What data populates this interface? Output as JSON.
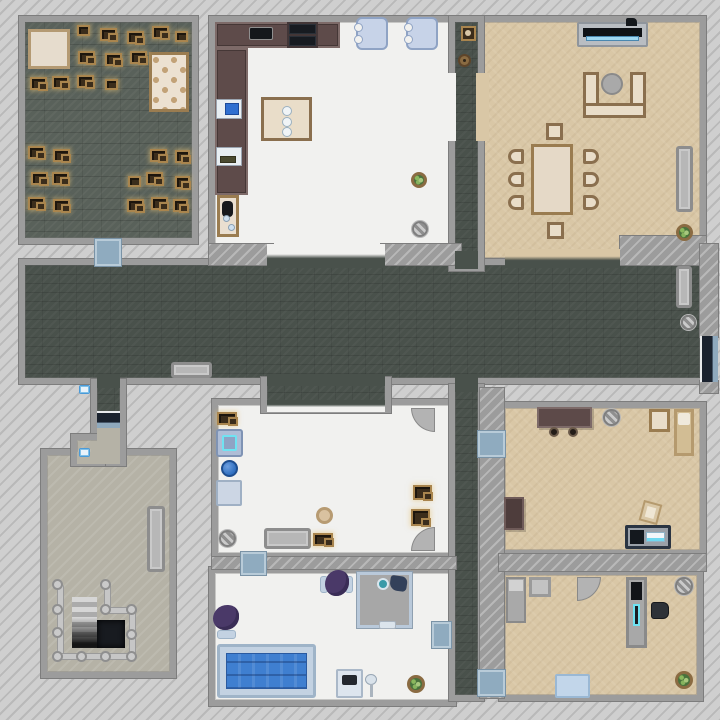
{
  "scene": {
    "title": "top-down house map",
    "canvas": {
      "w": 720,
      "h": 720
    }
  },
  "palette": {
    "exterior": "#cfcfcf",
    "wall": "#9c9c9c",
    "hallway_floor": "#49514b",
    "storage_floor": "#59615a",
    "white_floor": "#f1f1ef",
    "tan_floor": "#d9c7a6",
    "basement_floor": "#b5b2a6",
    "door_mat": "#8fabbf",
    "entry_door": "#1a222e",
    "water": "#3f7fd0",
    "highlight": "#6fe3f2",
    "crate": "#3b2d1b",
    "crate_trim": "#a9854e",
    "plant": "#49723c",
    "sofa_trim": "#8a6f4e",
    "counter": "#5e4b4a",
    "purple_chair": "#4a3968"
  },
  "rooms": [
    {
      "n": "storage-room",
      "f": "f-brickdark",
      "x": 25,
      "y": 22,
      "w": 167,
      "h": 216
    },
    {
      "n": "kitchen",
      "f": "f-white",
      "x": 215,
      "y": 22,
      "w": 235,
      "h": 226
    },
    {
      "n": "living-room",
      "f": "f-tan",
      "x": 482,
      "y": 22,
      "w": 218,
      "h": 236
    },
    {
      "n": "hallway",
      "f": "f-dark",
      "x": 25,
      "y": 265,
      "w": 675,
      "h": 113
    },
    {
      "n": "top-corridor",
      "f": "f-dark",
      "x": 455,
      "y": 22,
      "w": 23,
      "h": 243
    },
    {
      "n": "middle-room",
      "f": "f-white",
      "x": 218,
      "y": 405,
      "w": 237,
      "h": 148
    },
    {
      "n": "hall-alcove",
      "f": "f-dark",
      "x": 267,
      "y": 383,
      "w": 118,
      "h": 24
    },
    {
      "n": "bathroom",
      "f": "f-white",
      "x": 215,
      "y": 573,
      "w": 235,
      "h": 127
    },
    {
      "n": "vertical-corridor",
      "f": "f-dark",
      "x": 455,
      "y": 390,
      "w": 23,
      "h": 305
    },
    {
      "n": "bedroom-right",
      "f": "f-tan",
      "x": 505,
      "y": 408,
      "w": 195,
      "h": 142
    },
    {
      "n": "bedroom-bottom",
      "f": "f-tan",
      "x": 505,
      "y": 575,
      "w": 192,
      "h": 120
    },
    {
      "n": "basement-room",
      "f": "f-beige",
      "x": 47,
      "y": 455,
      "w": 123,
      "h": 217
    },
    {
      "n": "entry-corridor",
      "f": "f-dark",
      "x": 97,
      "y": 385,
      "w": 23,
      "h": 75
    },
    {
      "n": "entry-notch",
      "f": "f-beige",
      "x": 77,
      "y": 440,
      "w": 22,
      "h": 20
    }
  ],
  "walls": [
    {
      "n": "wall-living-nook",
      "x": 620,
      "y": 236,
      "w": 86,
      "h": 29
    },
    {
      "n": "wall-right-top",
      "x": 700,
      "y": 244,
      "w": 18,
      "h": 93
    },
    {
      "n": "wall-right-bottom",
      "x": 700,
      "y": 381,
      "w": 18,
      "h": 12
    },
    {
      "n": "wall-kitchen-hall-left",
      "x": 209,
      "y": 244,
      "w": 64,
      "h": 21
    },
    {
      "n": "wall-kitchen-hall-right",
      "x": 381,
      "y": 244,
      "w": 80,
      "h": 21
    },
    {
      "n": "wall-corridor-right",
      "x": 480,
      "y": 388,
      "w": 24,
      "h": 310
    },
    {
      "n": "wall-mid-bath",
      "x": 212,
      "y": 557,
      "w": 244,
      "h": 12
    },
    {
      "n": "wall-bedrooms",
      "x": 499,
      "y": 554,
      "w": 207,
      "h": 17
    }
  ],
  "patches": [
    {
      "n": "kitchen-hall-opening",
      "c": "c-grad-wd",
      "x": 267,
      "y": 244,
      "w": 118,
      "h": 24
    },
    {
      "n": "living-hall-opening",
      "c": "c-grad-td",
      "x": 505,
      "y": 249,
      "w": 115,
      "h": 19
    },
    {
      "n": "corridor-hall-join",
      "c": "c-dark",
      "x": 455,
      "y": 251,
      "w": 23,
      "h": 18
    },
    {
      "n": "corridor-kitchen-gap",
      "c": "c-white",
      "x": 442,
      "y": 73,
      "w": 14,
      "h": 68
    },
    {
      "n": "corridor-living-gap",
      "c": "c-tan",
      "x": 476,
      "y": 73,
      "w": 13,
      "h": 68
    },
    {
      "n": "vertcorr-hall-join",
      "c": "c-dark",
      "x": 455,
      "y": 374,
      "w": 23,
      "h": 18
    },
    {
      "n": "alcove-hall-join",
      "c": "c-dark",
      "x": 267,
      "y": 374,
      "w": 118,
      "h": 12
    },
    {
      "n": "alcove-room-join",
      "c": "c-grad-dw",
      "x": 267,
      "y": 400,
      "w": 118,
      "h": 12
    },
    {
      "n": "entry-hall-join",
      "c": "c-dark",
      "x": 97,
      "y": 374,
      "w": 23,
      "h": 14
    },
    {
      "n": "entry-beige-floor",
      "c": "c-beige",
      "x": 97,
      "y": 428,
      "w": 23,
      "h": 34
    },
    {
      "n": "entry-room-join",
      "c": "c-beige",
      "x": 97,
      "y": 450,
      "w": 23,
      "h": 14
    },
    {
      "n": "notch-join",
      "c": "c-beige",
      "x": 91,
      "y": 442,
      "w": 14,
      "h": 16
    },
    {
      "n": "notch-room-join",
      "c": "c-beige",
      "x": 77,
      "y": 452,
      "w": 22,
      "h": 12
    }
  ],
  "objects": [
    {
      "n": "floor-rug",
      "k": "rug",
      "x": 28,
      "y": 29,
      "w": 42,
      "h": 40
    },
    {
      "n": "tufted-board",
      "k": "board",
      "x": 149,
      "y": 52,
      "w": 40,
      "h": 60
    },
    {
      "n": "loot-crate",
      "k": "crate",
      "x": 77,
      "y": 25,
      "w": 13,
      "h": 11
    },
    {
      "n": "loot-crate-pair",
      "k": "crate2",
      "x": 100,
      "y": 28,
      "w": 17,
      "h": 13
    },
    {
      "n": "loot-crate-pair",
      "k": "crate2",
      "x": 127,
      "y": 31,
      "w": 17,
      "h": 13
    },
    {
      "n": "loot-crate-pair",
      "k": "crate2",
      "x": 152,
      "y": 26,
      "w": 17,
      "h": 13
    },
    {
      "n": "loot-crate",
      "k": "crate",
      "x": 175,
      "y": 31,
      "w": 13,
      "h": 11
    },
    {
      "n": "loot-crate-pair",
      "k": "crate2",
      "x": 78,
      "y": 51,
      "w": 17,
      "h": 13
    },
    {
      "n": "loot-crate-pair",
      "k": "crate2",
      "x": 105,
      "y": 53,
      "w": 17,
      "h": 13
    },
    {
      "n": "loot-crate-pair",
      "k": "crate2",
      "x": 130,
      "y": 51,
      "w": 17,
      "h": 13
    },
    {
      "n": "loot-crate-pair",
      "k": "crate2",
      "x": 30,
      "y": 77,
      "w": 17,
      "h": 13
    },
    {
      "n": "loot-crate-pair",
      "k": "crate2",
      "x": 52,
      "y": 76,
      "w": 17,
      "h": 13
    },
    {
      "n": "loot-crate-pair",
      "k": "crate2",
      "x": 77,
      "y": 75,
      "w": 17,
      "h": 13
    },
    {
      "n": "loot-crate",
      "k": "crate",
      "x": 105,
      "y": 79,
      "w": 13,
      "h": 11
    },
    {
      "n": "loot-crate-pair",
      "k": "crate2",
      "x": 28,
      "y": 146,
      "w": 17,
      "h": 13
    },
    {
      "n": "loot-crate-pair",
      "k": "crate2",
      "x": 53,
      "y": 149,
      "w": 17,
      "h": 13
    },
    {
      "n": "loot-crate-pair",
      "k": "crate2",
      "x": 150,
      "y": 149,
      "w": 17,
      "h": 13
    },
    {
      "n": "loot-crate-pair",
      "k": "crate2",
      "x": 175,
      "y": 150,
      "w": 15,
      "h": 13
    },
    {
      "n": "loot-crate-pair",
      "k": "crate2",
      "x": 31,
      "y": 172,
      "w": 17,
      "h": 13
    },
    {
      "n": "loot-crate-pair",
      "k": "crate2",
      "x": 52,
      "y": 172,
      "w": 17,
      "h": 13
    },
    {
      "n": "loot-crate",
      "k": "crate",
      "x": 128,
      "y": 176,
      "w": 13,
      "h": 11
    },
    {
      "n": "loot-crate-pair",
      "k": "crate2",
      "x": 146,
      "y": 172,
      "w": 17,
      "h": 13
    },
    {
      "n": "loot-crate-pair",
      "k": "crate2",
      "x": 175,
      "y": 176,
      "w": 15,
      "h": 13
    },
    {
      "n": "loot-crate-pair",
      "k": "crate2",
      "x": 28,
      "y": 197,
      "w": 17,
      "h": 13
    },
    {
      "n": "loot-crate-pair",
      "k": "crate2",
      "x": 53,
      "y": 199,
      "w": 17,
      "h": 13
    },
    {
      "n": "loot-crate-pair",
      "k": "crate2",
      "x": 127,
      "y": 199,
      "w": 17,
      "h": 13
    },
    {
      "n": "loot-crate-pair",
      "k": "crate2",
      "x": 151,
      "y": 197,
      "w": 17,
      "h": 13
    },
    {
      "n": "loot-crate-pair",
      "k": "crate2",
      "x": 173,
      "y": 199,
      "w": 15,
      "h": 13
    },
    {
      "n": "kitchen-counter-top",
      "k": "counter",
      "x": 215,
      "y": 22,
      "w": 125,
      "h": 26
    },
    {
      "n": "kitchen-counter-left",
      "k": "counter",
      "x": 215,
      "y": 48,
      "w": 33,
      "h": 147
    },
    {
      "n": "countertop-sink",
      "k": "cooktop",
      "x": 249,
      "y": 27,
      "w": 24,
      "h": 13
    },
    {
      "n": "stove",
      "k": "stove",
      "x": 287,
      "y": 22,
      "w": 31,
      "h": 26
    },
    {
      "n": "wall-sink",
      "k": "sink",
      "x": 216,
      "y": 99,
      "w": 26,
      "h": 20
    },
    {
      "n": "wall-shelf",
      "k": "shelf",
      "x": 216,
      "y": 147,
      "w": 26,
      "h": 19
    },
    {
      "n": "side-table-kitchen",
      "k": "smalltable",
      "x": 217,
      "y": 195,
      "w": 22,
      "h": 42
    },
    {
      "n": "island-table",
      "k": "island",
      "x": 261,
      "y": 97,
      "w": 51,
      "h": 44
    },
    {
      "n": "armchair-blue",
      "k": "bluechair",
      "x": 356,
      "y": 17,
      "w": 32,
      "h": 33
    },
    {
      "n": "armchair-blue",
      "k": "bluechair",
      "x": 406,
      "y": 17,
      "w": 32,
      "h": 33
    },
    {
      "n": "potted-plant",
      "k": "plant",
      "x": 411,
      "y": 172,
      "w": 16,
      "h": 16
    },
    {
      "n": "floor-drain",
      "k": "disc",
      "x": 412,
      "y": 221,
      "w": 16,
      "h": 16
    },
    {
      "n": "tv-stand",
      "k": "tvstand",
      "x": 577,
      "y": 22,
      "w": 71,
      "h": 25
    },
    {
      "n": "sectional-sofa",
      "k": "sofaU",
      "x": 583,
      "y": 72,
      "w": 63,
      "h": 46
    },
    {
      "n": "round-ottoman",
      "k": "ottoman",
      "x": 601,
      "y": 73,
      "w": 22,
      "h": 22
    },
    {
      "n": "dining-stool",
      "k": "stool",
      "x": 546,
      "y": 123,
      "w": 17,
      "h": 17
    },
    {
      "n": "dining-stool",
      "k": "stool",
      "x": 547,
      "y": 222,
      "w": 17,
      "h": 17
    },
    {
      "n": "dining-table",
      "k": "table",
      "x": 531,
      "y": 144,
      "w": 42,
      "h": 71
    },
    {
      "n": "dining-chair",
      "k": "chairL",
      "x": 508,
      "y": 149,
      "w": 16,
      "h": 15
    },
    {
      "n": "dining-chair",
      "k": "chairL",
      "x": 508,
      "y": 172,
      "w": 16,
      "h": 15
    },
    {
      "n": "dining-chair",
      "k": "chairL",
      "x": 508,
      "y": 195,
      "w": 16,
      "h": 15
    },
    {
      "n": "dining-chair",
      "k": "chairR",
      "x": 583,
      "y": 149,
      "w": 16,
      "h": 15
    },
    {
      "n": "dining-chair",
      "k": "chairR",
      "x": 583,
      "y": 172,
      "w": 16,
      "h": 15
    },
    {
      "n": "dining-chair",
      "k": "chairR",
      "x": 583,
      "y": 195,
      "w": 16,
      "h": 15
    },
    {
      "n": "wall-bench",
      "k": "benchv",
      "x": 676,
      "y": 146,
      "w": 17,
      "h": 66
    },
    {
      "n": "potted-plant",
      "k": "plant",
      "x": 676,
      "y": 224,
      "w": 17,
      "h": 17
    },
    {
      "n": "supply-crate",
      "k": "cratebox",
      "x": 461,
      "y": 26,
      "w": 15,
      "h": 15
    },
    {
      "n": "clay-pot",
      "k": "pot",
      "x": 458,
      "y": 54,
      "w": 13,
      "h": 13
    },
    {
      "n": "door-mat",
      "k": "mat",
      "x": 95,
      "y": 239,
      "w": 26,
      "h": 27
    },
    {
      "n": "hall-bench",
      "k": "benchh",
      "x": 171,
      "y": 362,
      "w": 41,
      "h": 16
    },
    {
      "n": "hall-bench",
      "k": "benchv",
      "x": 676,
      "y": 266,
      "w": 16,
      "h": 42
    },
    {
      "n": "floor-drain",
      "k": "disc",
      "x": 681,
      "y": 315,
      "w": 15,
      "h": 15
    },
    {
      "n": "entry-door",
      "k": "extdoorv",
      "x": 700,
      "y": 336,
      "w": 18,
      "h": 46
    },
    {
      "n": "loot-crate-pair",
      "k": "crate2",
      "x": 217,
      "y": 412,
      "w": 20,
      "h": 13
    },
    {
      "n": "washing-machine",
      "k": "washer",
      "x": 216,
      "y": 429,
      "w": 27,
      "h": 28
    },
    {
      "n": "ball",
      "k": "ball",
      "x": 221,
      "y": 460,
      "w": 17,
      "h": 17
    },
    {
      "n": "storage-box",
      "k": "lightbox",
      "x": 216,
      "y": 480,
      "w": 26,
      "h": 26
    },
    {
      "n": "floor-drain",
      "k": "disc",
      "x": 219,
      "y": 530,
      "w": 17,
      "h": 17
    },
    {
      "n": "bench",
      "k": "benchh",
      "x": 264,
      "y": 528,
      "w": 47,
      "h": 21
    },
    {
      "n": "loot-crate-pair",
      "k": "crate2",
      "x": 313,
      "y": 533,
      "w": 20,
      "h": 13
    },
    {
      "n": "round-stool",
      "k": "stooltan",
      "x": 316,
      "y": 507,
      "w": 17,
      "h": 17
    },
    {
      "n": "loot-crate-pair",
      "k": "crate2",
      "x": 413,
      "y": 485,
      "w": 19,
      "h": 15
    },
    {
      "n": "loot-crate-pair",
      "k": "crate2",
      "x": 411,
      "y": 509,
      "w": 19,
      "h": 17
    },
    {
      "n": "door-swing",
      "k": "arc",
      "r": "bl",
      "x": 411,
      "y": 408,
      "w": 24,
      "h": 24
    },
    {
      "n": "door-swing",
      "k": "arc",
      "r": "tl",
      "x": 411,
      "y": 527,
      "w": 24,
      "h": 24
    },
    {
      "n": "door-mat",
      "k": "mat",
      "x": 241,
      "y": 552,
      "w": 25,
      "h": 23
    },
    {
      "n": "bathtub-pool",
      "k": "tub",
      "x": 217,
      "y": 644,
      "w": 99,
      "h": 54
    },
    {
      "n": "upholstered-chair",
      "k": "pchair",
      "r": "t",
      "x": 320,
      "y": 572,
      "w": 33,
      "h": 26
    },
    {
      "n": "upholstered-chair",
      "k": "pchair",
      "r": "l",
      "x": 215,
      "y": 605,
      "w": 26,
      "h": 34
    },
    {
      "n": "shower-stall",
      "k": "shower",
      "x": 357,
      "y": 572,
      "w": 55,
      "h": 56
    },
    {
      "n": "sink-vanity",
      "k": "vanity",
      "x": 336,
      "y": 669,
      "w": 27,
      "h": 29
    },
    {
      "n": "floor-lamp",
      "k": "lamp",
      "x": 364,
      "y": 674,
      "w": 15,
      "h": 24
    },
    {
      "n": "potted-plant",
      "k": "plant",
      "x": 407,
      "y": 675,
      "w": 18,
      "h": 18
    },
    {
      "n": "door-mat",
      "k": "mat",
      "x": 432,
      "y": 622,
      "w": 19,
      "h": 26
    },
    {
      "n": "door-mat",
      "k": "mat",
      "x": 478,
      "y": 431,
      "w": 27,
      "h": 26
    },
    {
      "n": "door-mat",
      "k": "mat",
      "x": 478,
      "y": 670,
      "w": 27,
      "h": 26
    },
    {
      "n": "desk",
      "k": "desk",
      "x": 537,
      "y": 407,
      "w": 55,
      "h": 21
    },
    {
      "n": "desk-stool",
      "k": "knob",
      "x": 549,
      "y": 427,
      "w": 10,
      "h": 10
    },
    {
      "n": "desk-stool",
      "k": "knob",
      "x": 568,
      "y": 427,
      "w": 10,
      "h": 10
    },
    {
      "n": "floor-drain",
      "k": "disc",
      "x": 603,
      "y": 409,
      "w": 17,
      "h": 17
    },
    {
      "n": "nightstand",
      "k": "nightstand",
      "x": 649,
      "y": 409,
      "w": 21,
      "h": 23
    },
    {
      "n": "single-bed",
      "k": "bedtan",
      "x": 674,
      "y": 409,
      "w": 20,
      "h": 47
    },
    {
      "n": "dresser",
      "k": "dresser",
      "x": 504,
      "y": 497,
      "w": 20,
      "h": 33
    },
    {
      "n": "floor-cushion",
      "k": "cushion",
      "x": 641,
      "y": 502,
      "w": 19,
      "h": 21
    },
    {
      "n": "tv-console",
      "k": "tvconsole",
      "x": 625,
      "y": 525,
      "w": 46,
      "h": 24
    },
    {
      "n": "single-bed",
      "k": "bedgray",
      "x": 506,
      "y": 577,
      "w": 20,
      "h": 46
    },
    {
      "n": "side-table",
      "k": "tablegray",
      "x": 529,
      "y": 577,
      "w": 22,
      "h": 20
    },
    {
      "n": "door-swing",
      "k": "arc",
      "r": "br",
      "x": 577,
      "y": 577,
      "w": 24,
      "h": 24
    },
    {
      "n": "bookshelf",
      "k": "cabinet",
      "x": 626,
      "y": 577,
      "w": 21,
      "h": 71
    },
    {
      "n": "desk-chair",
      "k": "blackchair",
      "x": 651,
      "y": 602,
      "w": 18,
      "h": 17
    },
    {
      "n": "floor-drain",
      "k": "disc",
      "x": 675,
      "y": 577,
      "w": 18,
      "h": 18
    },
    {
      "n": "potted-plant",
      "k": "plant",
      "x": 675,
      "y": 671,
      "w": 18,
      "h": 18
    },
    {
      "n": "door-rug",
      "k": "rugblue",
      "x": 555,
      "y": 674,
      "w": 35,
      "h": 24
    },
    {
      "n": "wall-bench",
      "k": "benchv",
      "x": 147,
      "y": 506,
      "w": 18,
      "h": 66
    },
    {
      "n": "staircase-down",
      "k": "stairs",
      "x": 72,
      "y": 597,
      "w": 25,
      "h": 51
    },
    {
      "n": "stairwell-opening",
      "k": "hole",
      "x": 97,
      "y": 620,
      "w": 28,
      "h": 28
    },
    {
      "n": "stair-railing",
      "k": "railv",
      "x": 57,
      "y": 584,
      "w": 7,
      "h": 74
    },
    {
      "n": "stair-railing",
      "k": "railv",
      "x": 104,
      "y": 584,
      "w": 7,
      "h": 28
    },
    {
      "n": "stair-railing",
      "k": "railh",
      "x": 104,
      "y": 607,
      "w": 33,
      "h": 7
    },
    {
      "n": "stair-railing",
      "k": "railv",
      "x": 129,
      "y": 609,
      "w": 7,
      "h": 49
    },
    {
      "n": "stair-railing",
      "k": "railh",
      "x": 57,
      "y": 653,
      "w": 79,
      "h": 7
    },
    {
      "n": "railing-post",
      "k": "post",
      "x": 52,
      "y": 579,
      "w": 11,
      "h": 11
    },
    {
      "n": "railing-post",
      "k": "post",
      "x": 100,
      "y": 579,
      "w": 11,
      "h": 11
    },
    {
      "n": "railing-post",
      "k": "post",
      "x": 52,
      "y": 604,
      "w": 11,
      "h": 11
    },
    {
      "n": "railing-post",
      "k": "post",
      "x": 100,
      "y": 604,
      "w": 11,
      "h": 11
    },
    {
      "n": "railing-post",
      "k": "post",
      "x": 126,
      "y": 604,
      "w": 11,
      "h": 11
    },
    {
      "n": "railing-post",
      "k": "post",
      "x": 52,
      "y": 627,
      "w": 11,
      "h": 11
    },
    {
      "n": "railing-post",
      "k": "post",
      "x": 126,
      "y": 629,
      "w": 11,
      "h": 11
    },
    {
      "n": "railing-post",
      "k": "post",
      "x": 52,
      "y": 651,
      "w": 11,
      "h": 11
    },
    {
      "n": "railing-post",
      "k": "post",
      "x": 76,
      "y": 651,
      "w": 11,
      "h": 11
    },
    {
      "n": "railing-post",
      "k": "post",
      "x": 100,
      "y": 651,
      "w": 11,
      "h": 11
    },
    {
      "n": "railing-post",
      "k": "post",
      "x": 126,
      "y": 651,
      "w": 11,
      "h": 11
    },
    {
      "n": "light-switch",
      "k": "switch",
      "x": 79,
      "y": 385,
      "w": 11,
      "h": 9
    },
    {
      "n": "light-switch",
      "k": "switch",
      "x": 79,
      "y": 448,
      "w": 11,
      "h": 9
    },
    {
      "n": "entry-door",
      "k": "extdoorh",
      "x": 97,
      "y": 411,
      "w": 23,
      "h": 17
    }
  ]
}
